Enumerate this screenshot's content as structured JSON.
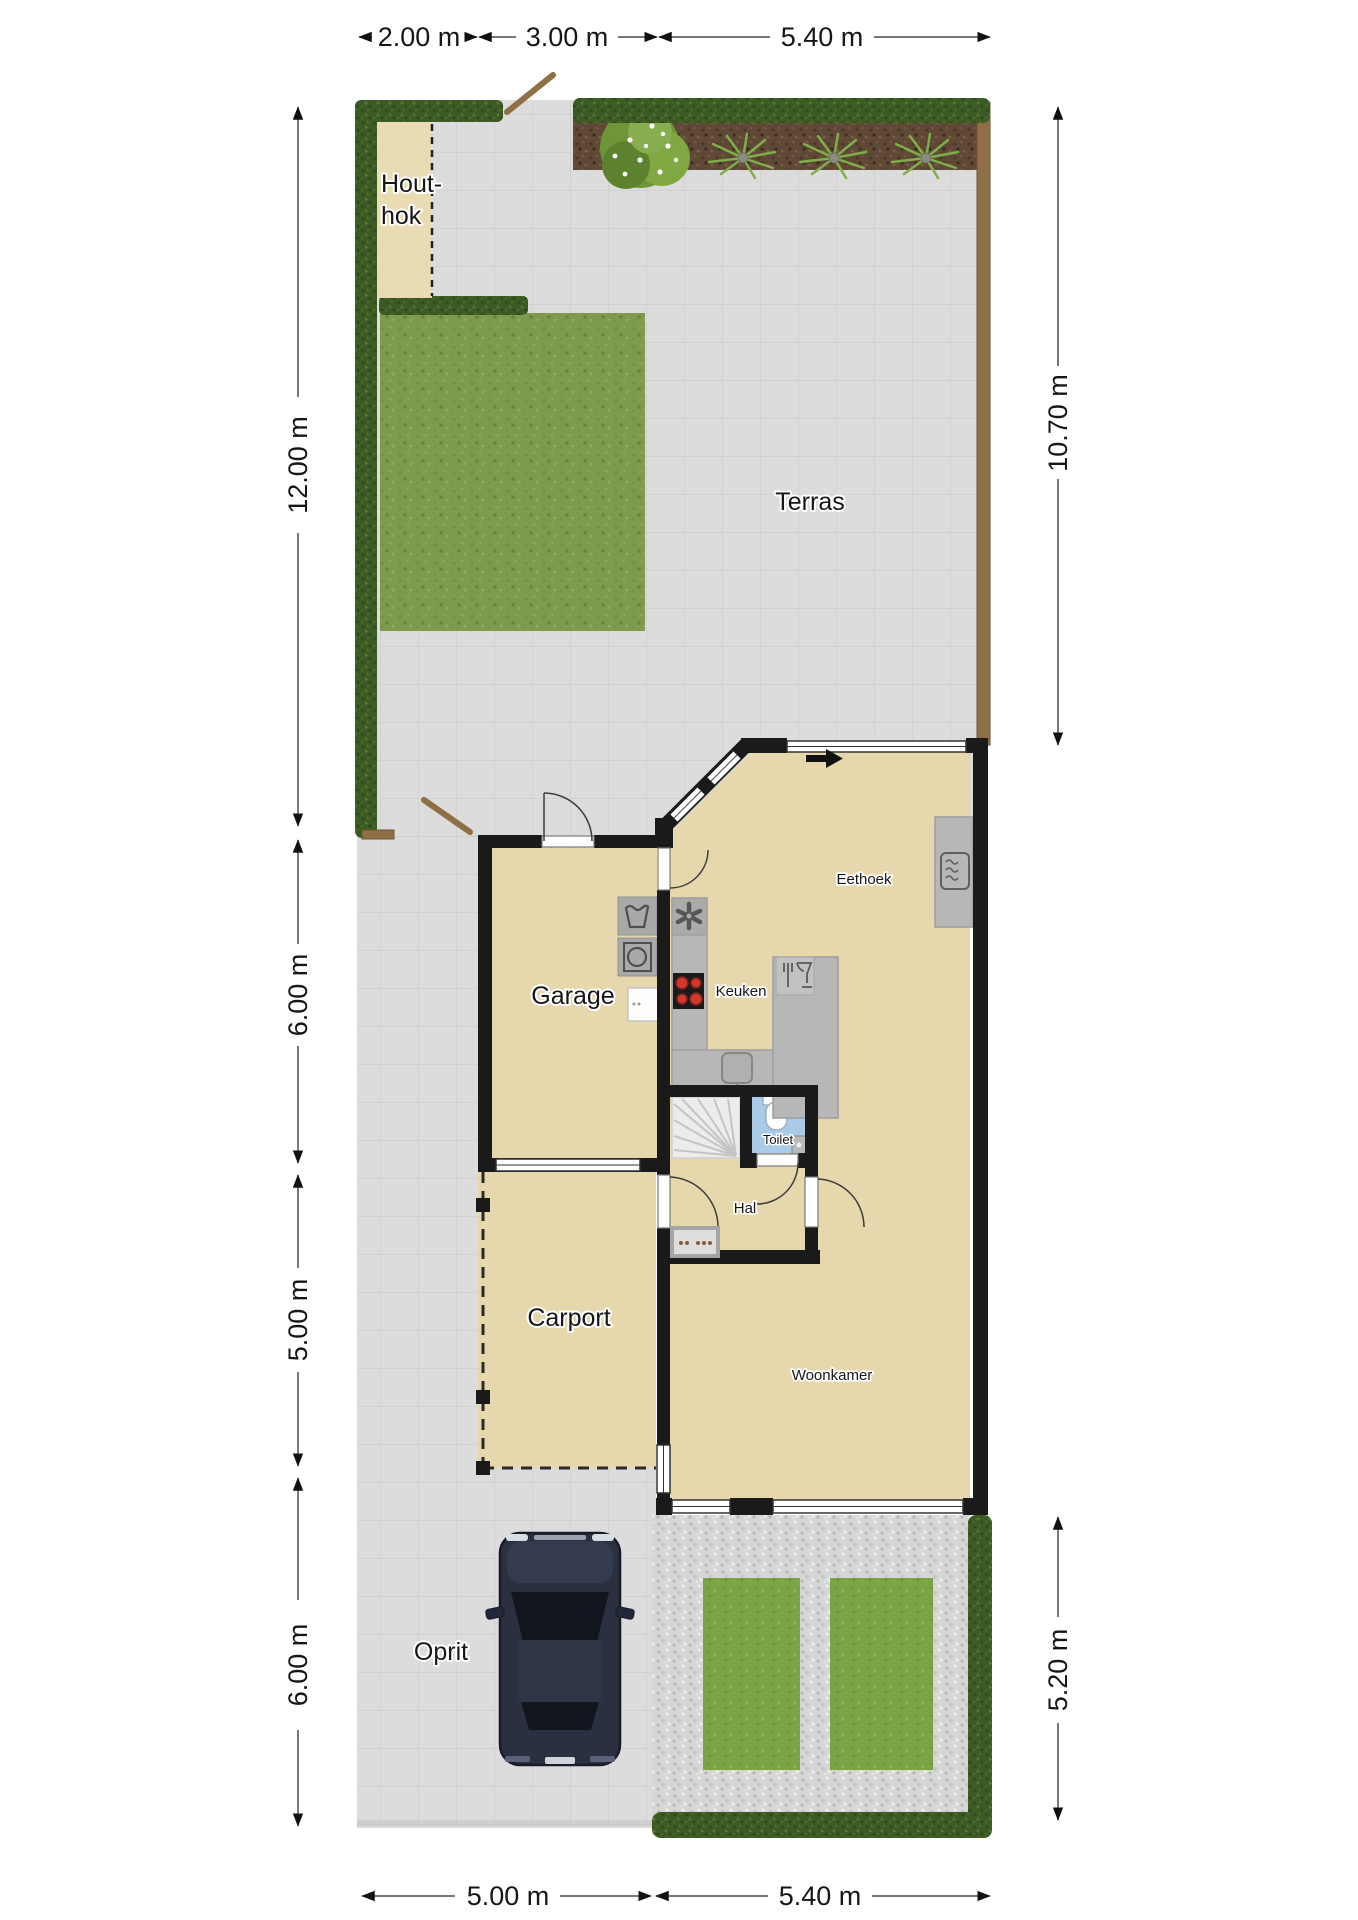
{
  "plan": {
    "type": "floorplan-with-garden",
    "rooms": {
      "houthok_line1": "Hout-",
      "houthok_line2": "hok",
      "terras": "Terras",
      "garage": "Garage",
      "eethoek": "Eethoek",
      "keuken": "Keuken",
      "toilet": "Toilet",
      "hal": "Hal",
      "carport": "Carport",
      "woonkamer": "Woonkamer",
      "oprit": "Oprit"
    },
    "dimensions": {
      "top_1": "2.00 m",
      "top_2": "3.00 m",
      "top_3": "5.40 m",
      "left_1": "12.00 m",
      "left_2": "6.00 m",
      "left_3": "5.00 m",
      "left_4": "6.00 m",
      "right_1": "10.70 m",
      "right_2": "5.20 m",
      "bottom_1": "5.00 m",
      "bottom_2": "5.40 m"
    },
    "colors": {
      "wall": "#1a1a1a",
      "floor_beige": "#e6d8ac",
      "terras_tile": "#dcdcdc",
      "hedge_green": "#3c5a23",
      "lawn_green": "#7e9a4d",
      "grass_patch": "#7aa343",
      "soil_brown": "#5f4836",
      "gravel_gray": "#d6d6d6",
      "toilet_blue": "#a9cbe8",
      "counter_gray": "#b7b7b7",
      "fence_brown": "#8f6f45",
      "car_body": "#2a303f",
      "burner_red": "#d03a2e"
    }
  }
}
